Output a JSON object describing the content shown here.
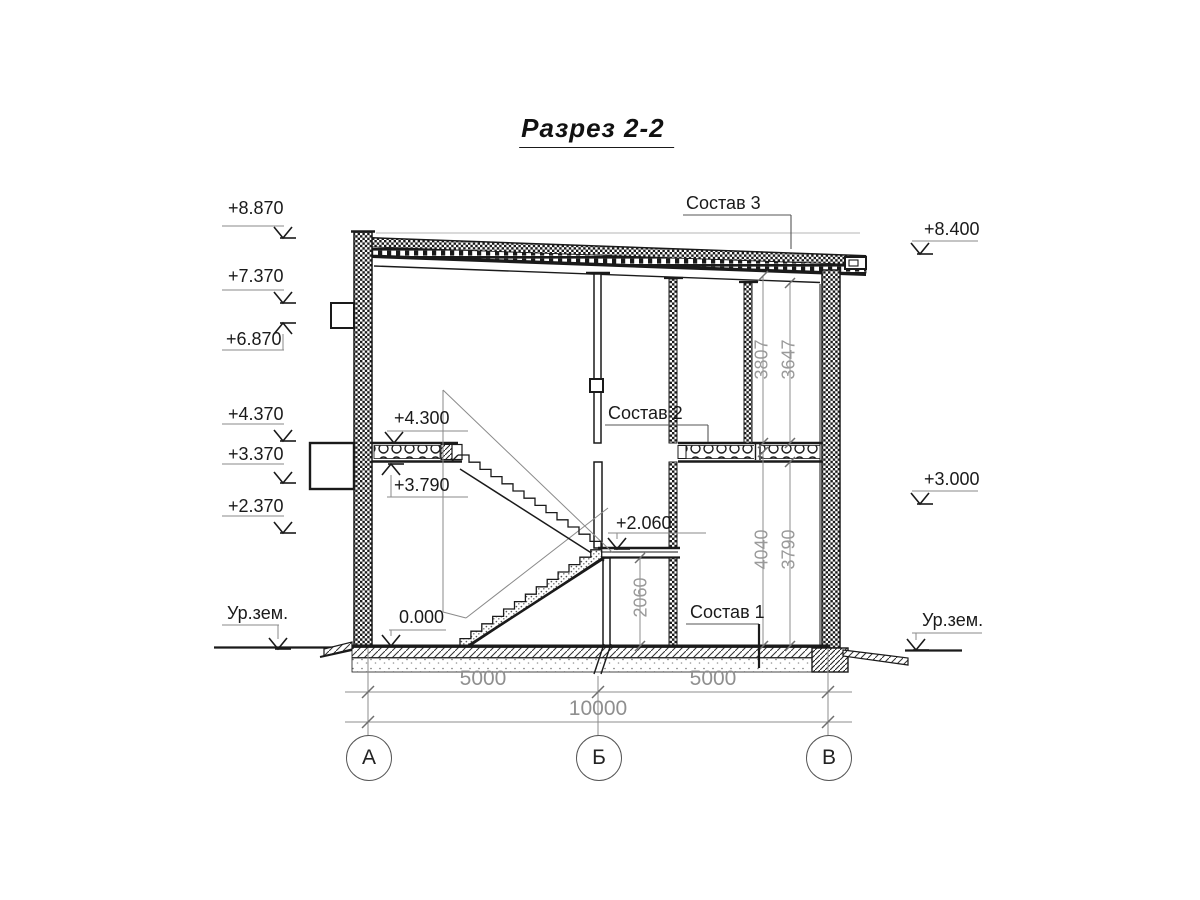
{
  "title": "Разрез 2-2",
  "marks": {
    "left": [
      "+8.870",
      "+7.370",
      "+6.870",
      "+4.370",
      "+3.370",
      "+2.370"
    ],
    "ground_left": "Ур.зем.",
    "right": [
      "+8.400",
      "+3.000"
    ],
    "ground_right": "Ур.зем.",
    "interior": {
      "upper_slab_top": "+4.300",
      "upper_slab_bottom": "+3.790",
      "landing": "+2.060",
      "floor": "0.000"
    }
  },
  "layer_labels": {
    "roof": "Состав 3",
    "floor2": "Состав 2",
    "floor1": "Состав 1"
  },
  "dimensions": {
    "upper_room": [
      "3807",
      "3647"
    ],
    "lower_room": [
      "4040",
      "3790"
    ],
    "landing_height": "2060",
    "spans": [
      "5000",
      "5000"
    ],
    "total_span": "10000"
  },
  "axes": [
    "А",
    "Б",
    "В"
  ],
  "colors": {
    "line": "#1a1a1a",
    "dim": "#919191",
    "leader": "#555555"
  }
}
